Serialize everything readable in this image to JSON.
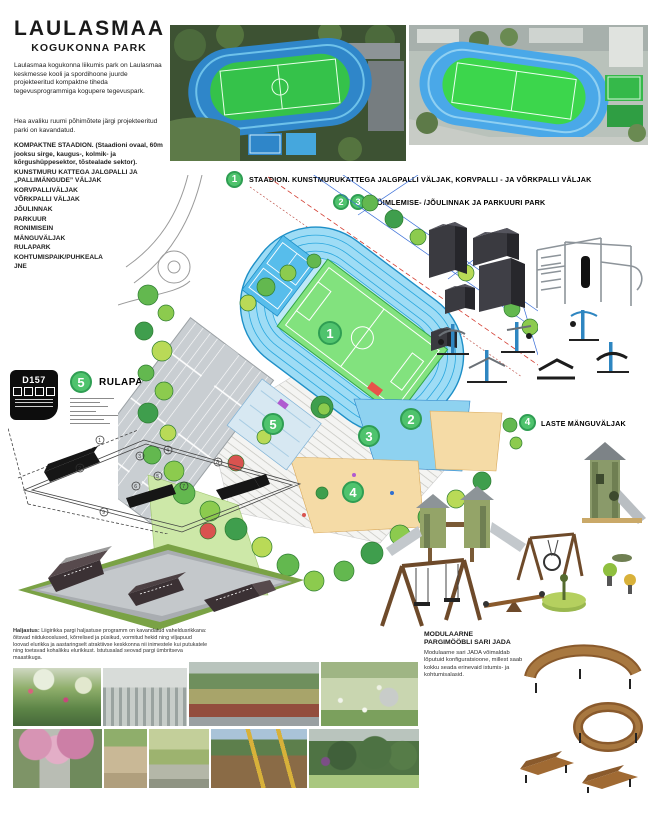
{
  "title": {
    "line1": "LAULASMAA",
    "line2": "KOGUKONNA PARK"
  },
  "intro": {
    "p1": "Laulasmaa kogukonna liikumis park on Laulasmaa keskmesse kooli ja spordihoone juurde projekteeritud kompaktne tiheda tegevusprogrammiga kogupere tegevuspark.",
    "p2": "Hea avaliku ruumi põhimõtete järgi projekteeritud parki on kavandatud."
  },
  "facilities": [
    "KOMPAKTNE STAADION. (Staadioni ovaal, 60m jooksu sirge, kaugus-, kolmik- ja kõrgushüppesektor, tõstealade sektor).",
    "KUNSTMURU KATTEGA JALGPALLI JA „PALLIMÄNGUDE” VÄLJAK",
    "KORVPALLIVÄLJAK",
    "VÕRKPALLI VÄLJAK",
    "JÕULINNAK",
    "PARKUUR",
    "RONIMISEIN",
    "MÄNGUVÄLJAK",
    "RULAPARK",
    "KOHTUMISPAIK/PUHKEALA",
    "JNE"
  ],
  "sections": {
    "s1": {
      "num": "1",
      "label": "STAADION. KUNSTMURUKATTEGA JALGPALLI VÄLJAK, KORVPALLI - JA VÕRKPALLI VÄLJAK"
    },
    "s23": {
      "num2": "2",
      "num3": "3",
      "label": "VÕIMLEMISE- /JÕULINNAK JA PARKUURI PARK"
    },
    "s4": {
      "num": "4",
      "label": "LASTE MÄNGUVÄLJAK"
    },
    "s5": {
      "num": "5",
      "label": "RULAPARK"
    }
  },
  "plan_badges": [
    "1",
    "2",
    "3",
    "4",
    "5"
  ],
  "stamp": {
    "code": "D157"
  },
  "skatepark": {
    "plan_numbers": [
      "1",
      "2",
      "3",
      "4",
      "5",
      "6",
      "7",
      "8",
      "9"
    ]
  },
  "furniture": {
    "title1": "MODULAARNE",
    "title2": "PARGIMÖÖBLI SARI JADA",
    "body": "Modulaarne sari JADA võimaldab lõputuid konfiguratsioone, millest saab kokku seada erinevaid istumis- ja kohtumisalasid."
  },
  "fineprint": {
    "heading": "Haljastus:",
    "body": "Liigirikka pargi haljastuse programm on kavandatud vaheldusrikkana: õitsvad niidukooslused, kõrrelised ja püsikud, vormitud hekid ning viljapuud loovad elurikka ja aastaringselt atraktiivse keskkonna nii inimestele kui putukatele ning toetavad kohalikku elurikkust. Istutusalad seovad pargi ümbritseva maastikuga."
  },
  "photos": {
    "names": [
      "meadow-flowers",
      "park-path-building",
      "street-planting",
      "bench-meadow",
      "cherry-blossom-path",
      "gravel-garden",
      "autumn-path",
      "playground-hammock",
      "shrub-border"
    ]
  },
  "colors": {
    "badge_fill": "#4fc36d",
    "badge_stroke": "#2f9e53",
    "track_blue": "#9edcf5",
    "field_green": "#82e27e",
    "court_blue": "#57bdeb",
    "playground_beige": "#f5dba6",
    "parking_gray": "#c9ced2",
    "wood_brown": "#8a5a2c"
  }
}
